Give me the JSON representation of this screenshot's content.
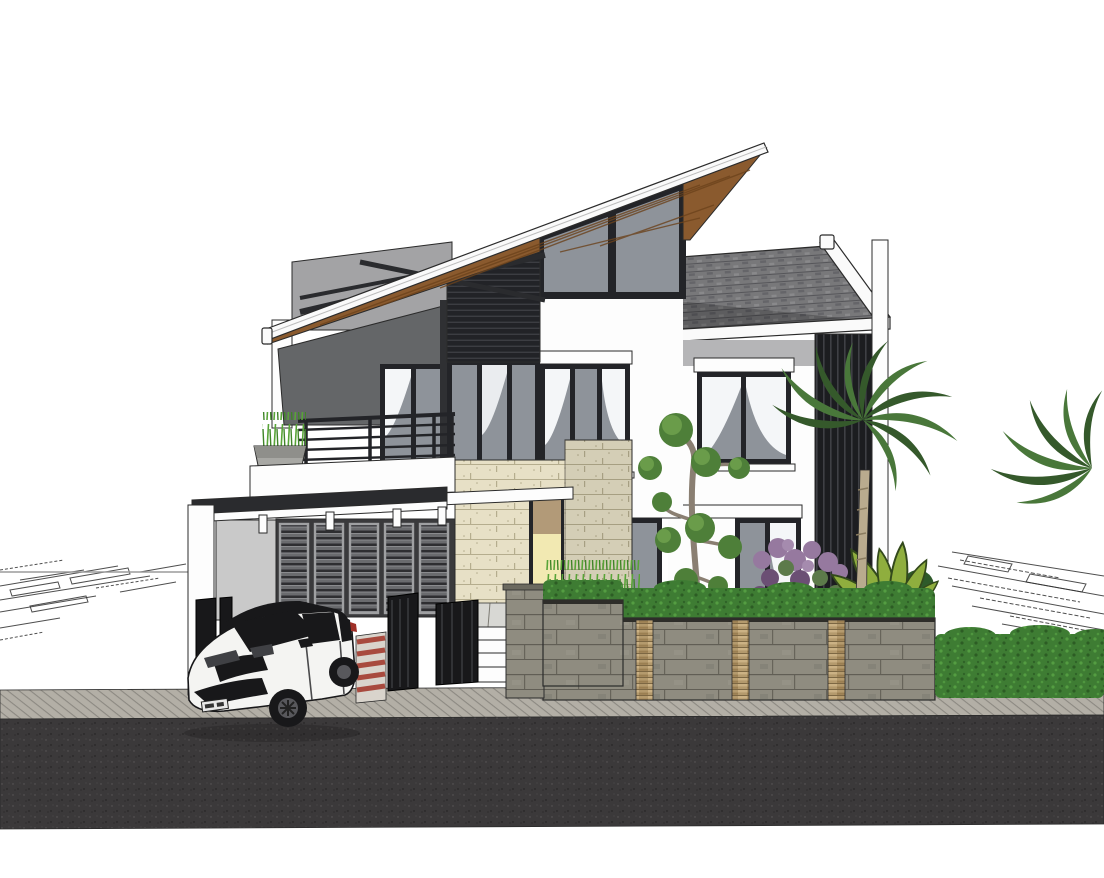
{
  "meta": {
    "title": "Modern tropical two-storey house — 3D architectural render",
    "canvas": {
      "width": 1104,
      "height": 878
    }
  },
  "scene": {
    "description": "SketchUp-style 3D exterior render of a modern two-storey house with a steep mono-pitch wooden-soffit roof, clerestory glazing, grey shingle gable roof, cream split-stone entry wall, dark louvre screens, carport with slatted doors, white SUV parked in front, stone fence with hedge, palm trees and tropical planting, paved sidewalk and asphalt road; faint CAD site-plan linework on the white ground plane",
    "objects": [
      {
        "name": "skillion-roof",
        "label": "Slanted roof with wooden soffit and white fascia"
      },
      {
        "name": "clerestory-window",
        "label": "Triangular clerestory glazing under roof apex"
      },
      {
        "name": "gable-roof",
        "label": "Grey shingle gable roof"
      },
      {
        "name": "back-wall",
        "label": "Light grey background wall wedge"
      },
      {
        "name": "terrace-dark-wall",
        "label": "Dark grey angled terrace wall"
      },
      {
        "name": "roof-braces",
        "label": "Exposed dark timber brace beams"
      },
      {
        "name": "louvre-band",
        "label": "Dark horizontal louvre band"
      },
      {
        "name": "balcony",
        "label": "Balcony with dark metal railing, planter and white parapet"
      },
      {
        "name": "carport",
        "label": "Carport with dark flat canopy and white posts"
      },
      {
        "name": "garage-doors",
        "label": "Slatted louvre garage doors, five panels"
      },
      {
        "name": "entry",
        "label": "Entry with cream split-stone wall, yellow door and steps"
      },
      {
        "name": "entry-canopy",
        "label": "White entry canopy slab"
      },
      {
        "name": "gates",
        "label": "Dark metal gate panels"
      },
      {
        "name": "gate-pillar",
        "label": "Stone gate pillar"
      },
      {
        "name": "windows",
        "label": "Dark-framed windows with white curtains"
      },
      {
        "name": "louvre-screen",
        "label": "Dark vertical louvre privacy screen"
      },
      {
        "name": "fence-wall",
        "label": "Grey stone fence with tan stacked-stone strips and hedge on top"
      },
      {
        "name": "hedge-right",
        "label": "Trimmed green hedge"
      },
      {
        "name": "palm-trees",
        "label": "Palm trees"
      },
      {
        "name": "bonsai-tree",
        "label": "Sculpted topiary tree"
      },
      {
        "name": "purple-shrub",
        "label": "Purple flowering shrub"
      },
      {
        "name": "leafy-plant",
        "label": "Large-leaf tropical plant"
      },
      {
        "name": "garden-grass",
        "label": "Ornamental grass strip"
      },
      {
        "name": "car",
        "label": "White compact SUV with black roof, parked at driveway"
      },
      {
        "name": "license-plate",
        "label": "Small white license plate, characters not legible"
      },
      {
        "name": "ramp",
        "label": "Red and white striped kerb ramp"
      },
      {
        "name": "sidewalk",
        "label": "Textured paver sidewalk"
      },
      {
        "name": "road",
        "label": "Dark asphalt road"
      },
      {
        "name": "site-plan-lines",
        "label": "Faint CAD plan linework on ground plane"
      }
    ]
  },
  "colors": {
    "background": "#ffffff",
    "fascia_white": "#fafafa",
    "outline_dark": "#2b2b2b",
    "wood_roof": "#8a5a2e",
    "wood_dark": "#6b421c",
    "shingle_gray": "#78787a",
    "shingle_dark": "#56565a",
    "glass_gray": "#8e939a",
    "frame_dark": "#232428",
    "wall_white": "#fdfdfd",
    "wall_gray_band": "#b5b5b7",
    "back_wall_gray": "#a3a3a5",
    "dark_wall_gray": "#646668",
    "side_wall_gray": "#c9c9c9",
    "louver_dark": "#222327",
    "louver_mid": "#6a6b6e",
    "canopy_dark": "#2a2b2e",
    "stone_cream": "#e7e0c6",
    "stone_cream_line": "#b5ad8e",
    "stone_gray": "#8f8c80",
    "stone_joint": "#55534a",
    "stack_tan": "#b49a6d",
    "door_yellow": "#f2e9b2",
    "door_tan": "#b29a78",
    "curtain_white": "#f4f6f8",
    "hedge_green": "#3e7c33",
    "hedge_light": "#57a144",
    "grass_green": "#58a437",
    "leaf_green": "#8fae3e",
    "leaf_dark": "#33491c",
    "palm_green": "#49773a",
    "palm_dark": "#35592b",
    "bonsai_green": "#4e7f39",
    "bonsai_light": "#6a9c4a",
    "purple_bloom": "#96799f",
    "trunk_gray": "#8a7f72",
    "palm_trunk": "#b9ab8e",
    "road_asphalt": "#3b393a",
    "sidewalk_gray": "#b3afa6",
    "paver_gray": "#b9b5ab",
    "ramp_red": "#a84a3e",
    "ramp_white": "#d9d4cc",
    "car_white": "#f4f4f2",
    "car_dark": "#18181a",
    "plate_white": "#e8e8e8",
    "plan_line": "#2f2f2f"
  }
}
